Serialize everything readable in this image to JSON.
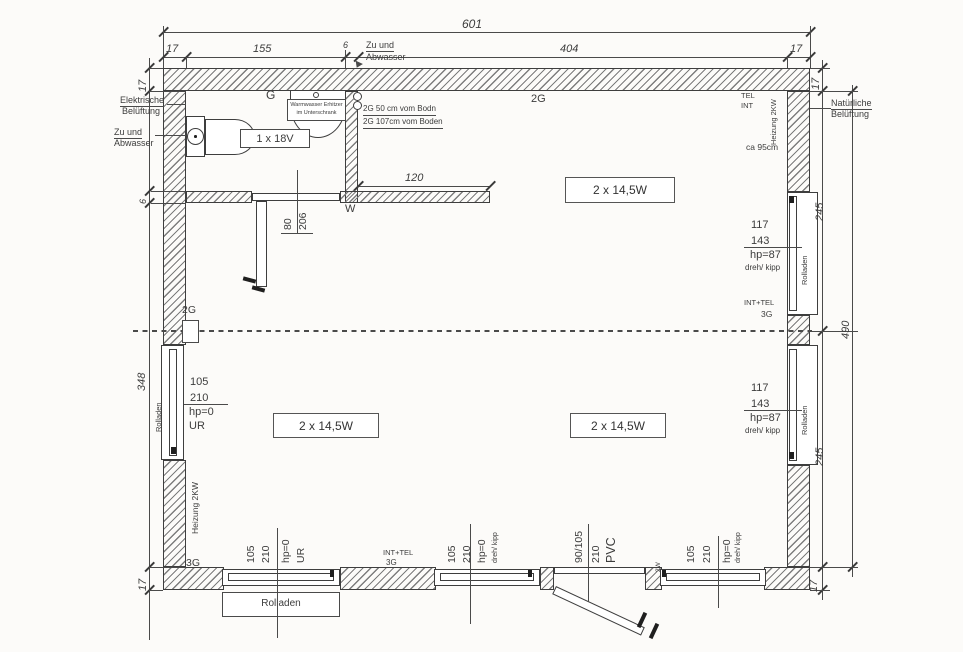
{
  "plan": {
    "rooms": {
      "top": "2 x 14,5W",
      "bottom_left": "2 x 14,5W",
      "bottom_right": "2 x 14,5W"
    },
    "dims": {
      "total_width": "601",
      "wall_t": "17",
      "bath_w": "155",
      "partition": "6",
      "main_w": "404",
      "left_h": "348",
      "right_seg": "245",
      "total_h": "490",
      "nook": "120",
      "bath_door_w": "80",
      "bath_door_h": "206"
    },
    "bath": {
      "label_g": "G",
      "boiler1": "Warmwasser Erhitzer",
      "boiler2": "im Unterschrank",
      "fixture_18v": "1 x 18V",
      "pipe_upper": "2G 50 cm vom Bodn",
      "pipe_lower": "2G 107cm vom Boden",
      "w_mark": "W"
    },
    "ann": {
      "zu_und": "Zu und",
      "abwasser": "Abwasser",
      "elektrische": "Elektrische",
      "belueftung": "Belüftung",
      "natuerliche": "Natürliche",
      "tel": "TEL",
      "int": "INT",
      "int_tel": "INT+TEL",
      "heizung": "Heizung 2KW",
      "ca95": "ca 95cm",
      "g2": "2G",
      "g3": "3G",
      "w2": "2W",
      "rolladen": "Rolladen"
    },
    "win": {
      "left": {
        "w": "105",
        "h": "210",
        "hp": "hp=0",
        "type": "UR"
      },
      "right_top": {
        "w": "117",
        "h": "143",
        "hp": "hp=87",
        "type": "dreh/ kipp"
      },
      "right_bottom": {
        "w": "117",
        "h": "143",
        "hp": "hp=87",
        "type": "dreh/ kipp"
      },
      "b1": {
        "w": "105",
        "h": "210",
        "hp": "hp=0",
        "type": "UR"
      },
      "b2": {
        "w": "105",
        "h": "210",
        "hp": "hp=0",
        "type": "dreh/ kipp"
      },
      "b3": {
        "w": "105",
        "h": "210",
        "hp": "hp=0",
        "type": "dreh/ kipp"
      },
      "door": {
        "w": "90/105",
        "h": "210",
        "mat": "PVC"
      }
    }
  }
}
